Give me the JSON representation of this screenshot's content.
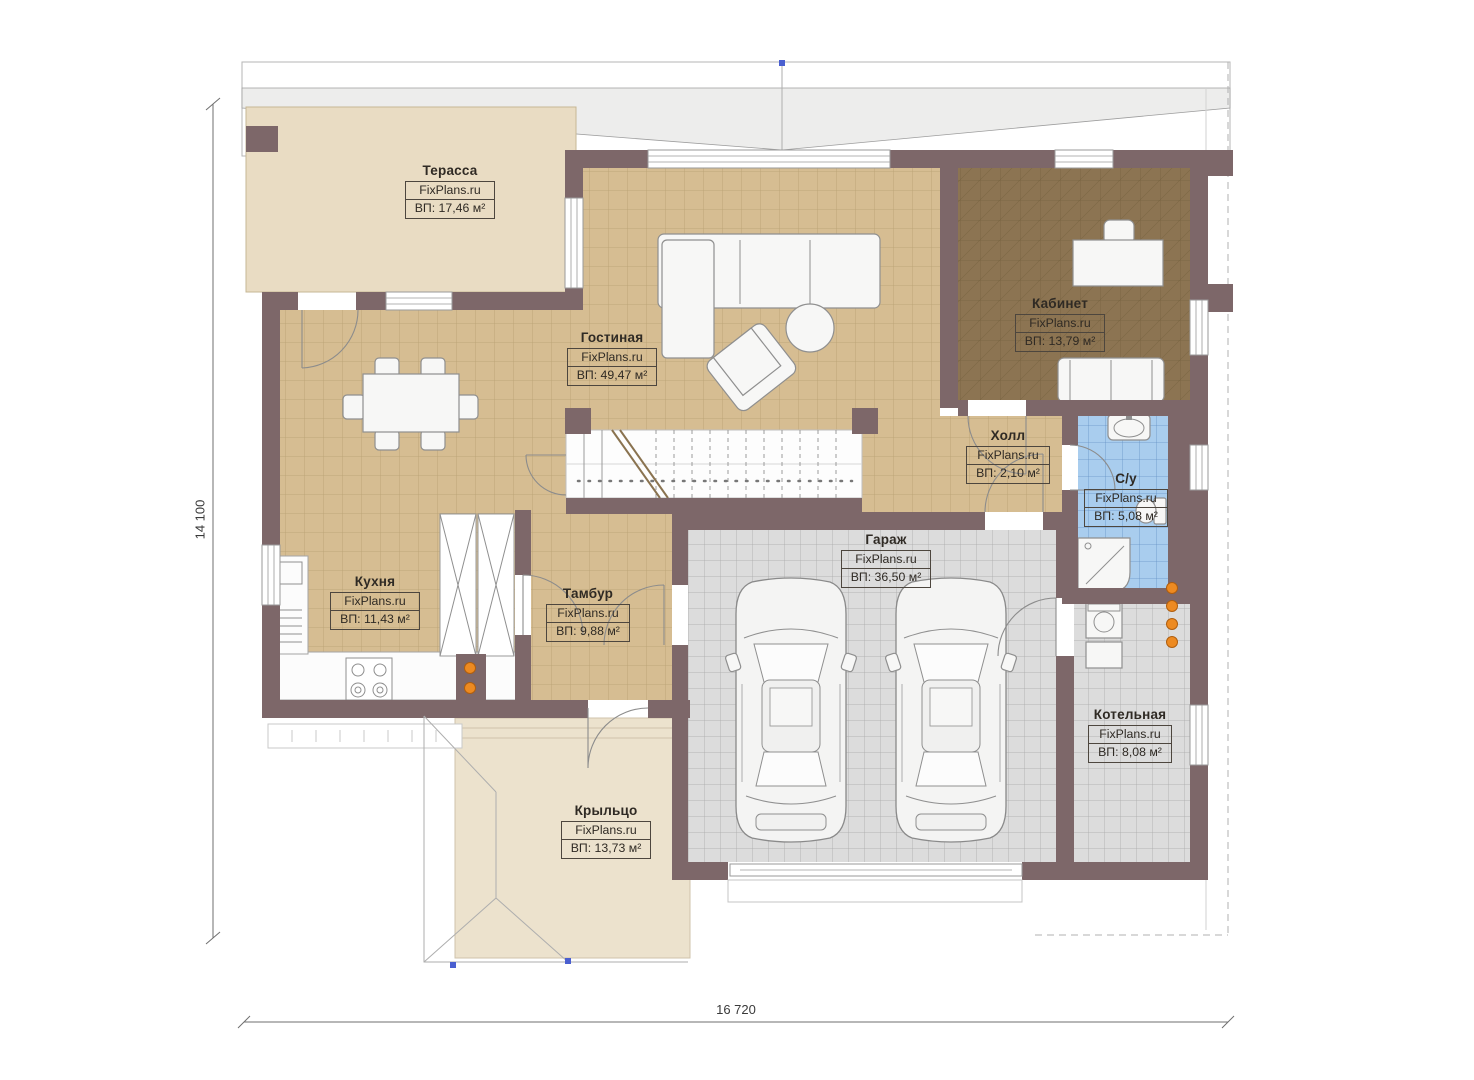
{
  "plan": {
    "brand": "FixPlans.ru",
    "dimensions": {
      "height_label": "14 100",
      "width_label": "16 720"
    },
    "rooms": [
      {
        "id": "terrace",
        "name": "Терасса",
        "brand": "FixPlans.ru",
        "area": "ВП: 17,46 м²"
      },
      {
        "id": "living",
        "name": "Гостиная",
        "brand": "FixPlans.ru",
        "area": "ВП: 49,47 м²"
      },
      {
        "id": "office",
        "name": "Кабинет",
        "brand": "FixPlans.ru",
        "area": "ВП: 13,79 м²"
      },
      {
        "id": "hall",
        "name": "Холл",
        "brand": "FixPlans.ru",
        "area": "ВП: 2,10 м²"
      },
      {
        "id": "bathroom",
        "name": "С/у",
        "brand": "FixPlans.ru",
        "area": "ВП: 5,08 м²"
      },
      {
        "id": "kitchen",
        "name": "Кухня",
        "brand": "FixPlans.ru",
        "area": "ВП: 11,43 м²"
      },
      {
        "id": "vestibule",
        "name": "Тамбур",
        "brand": "FixPlans.ru",
        "area": "ВП: 9,88 м²"
      },
      {
        "id": "garage",
        "name": "Гараж",
        "brand": "FixPlans.ru",
        "area": "ВП: 36,50 м²"
      },
      {
        "id": "boiler",
        "name": "Котельная",
        "brand": "FixPlans.ru",
        "area": "ВП: 8,08 м²"
      },
      {
        "id": "porch",
        "name": "Крыльцо",
        "brand": "FixPlans.ru",
        "area": "ВП: 13,73 м²"
      }
    ],
    "colors": {
      "wall": "#7d6769",
      "floor_tan": "#d6bd92",
      "floor_office": "#8c7452",
      "floor_blue": "#a9cdee",
      "floor_gray": "#dcdcdc",
      "floor_terrace": "#e9dcc3",
      "floor_porch": "#ece2cd",
      "accent_orange": "#ed8a21"
    }
  }
}
